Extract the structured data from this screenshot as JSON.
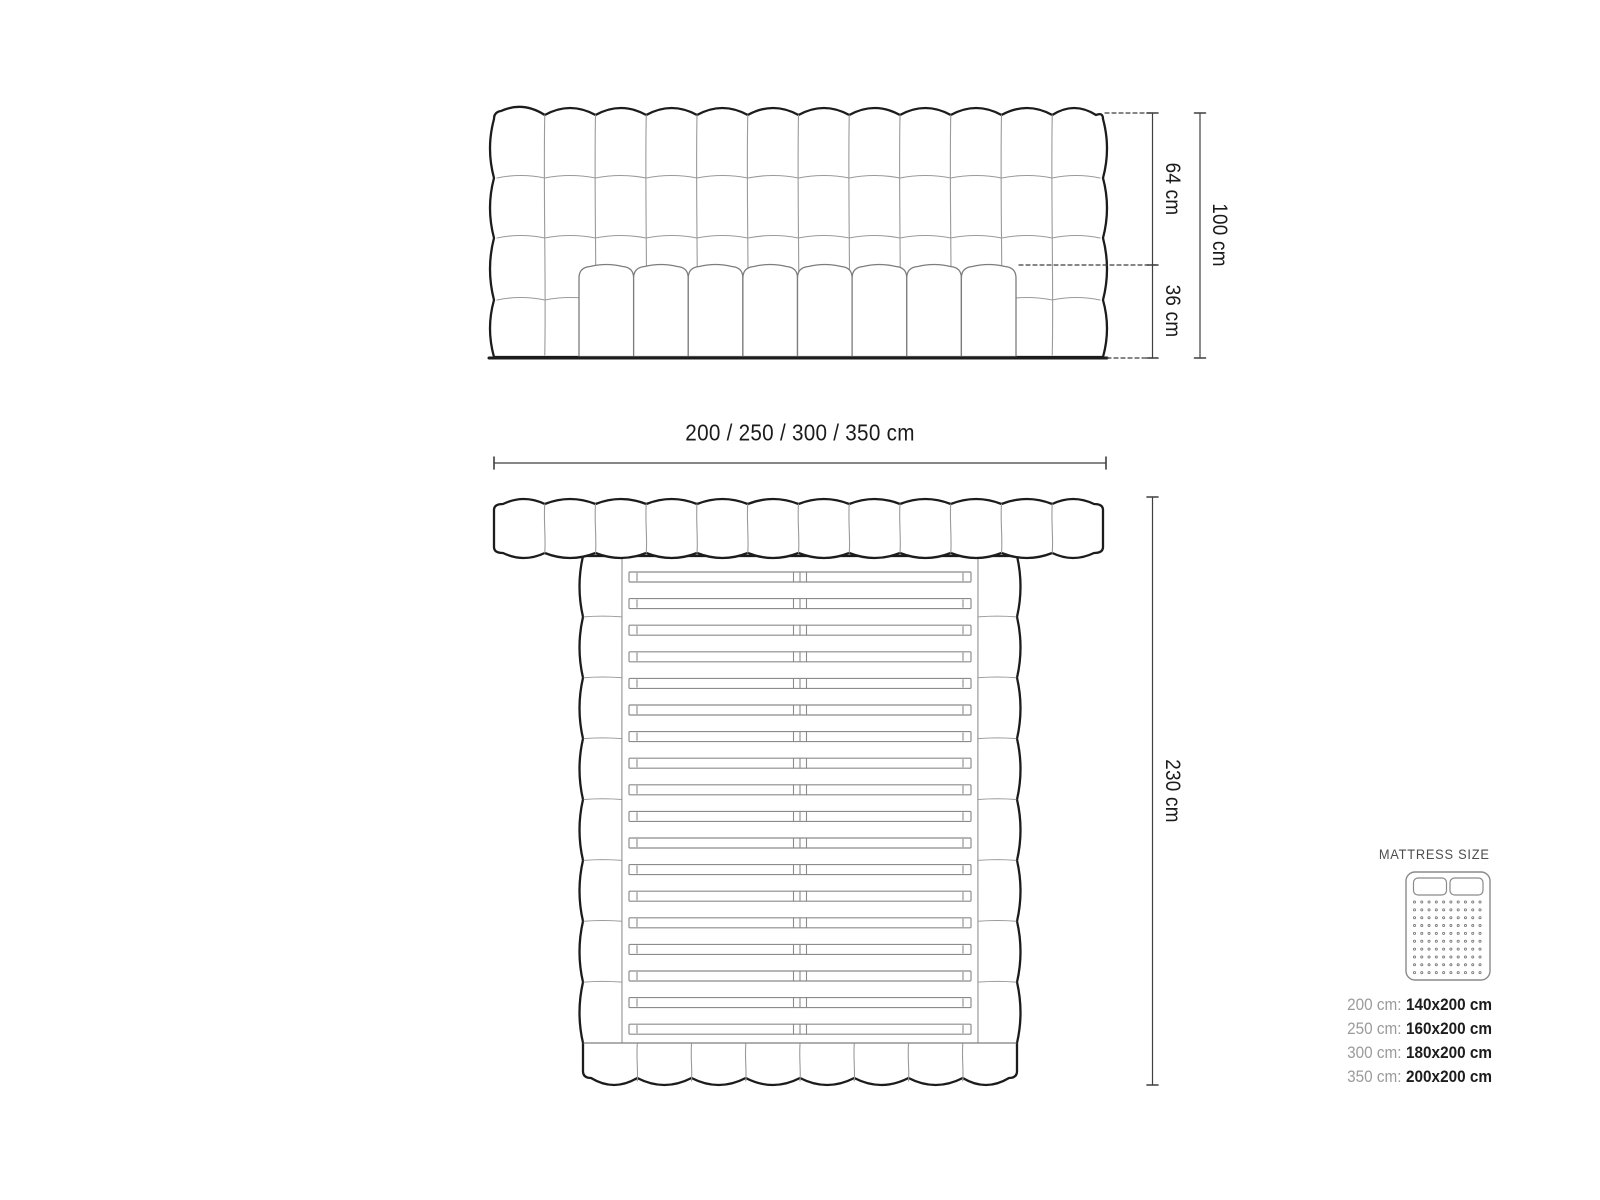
{
  "figure": {
    "front_view": {
      "dim_height_upper": "64 cm",
      "dim_height_lower": "36 cm",
      "dim_height_total": "100 cm",
      "dim_width": "200 / 250 / 300 / 350 cm",
      "headboard_columns": 12,
      "headboard_rows": 4,
      "mattress_panels": 8
    },
    "top_view": {
      "dim_length": "230 cm",
      "headboard_segments": 12,
      "footboard_segments": 8,
      "rail_blocks": 8,
      "slats": 18
    }
  },
  "legend": {
    "title": "MATTRESS SIZE",
    "rows": [
      {
        "frame": "200 cm:",
        "mattress": "140x200 cm"
      },
      {
        "frame": "250 cm:",
        "mattress": "160x200 cm"
      },
      {
        "frame": "300 cm:",
        "mattress": "180x200 cm"
      },
      {
        "frame": "350 cm:",
        "mattress": "200x200 cm"
      }
    ]
  },
  "colors": {
    "background": "#ffffff",
    "outline_dark": "#1c1c1c",
    "tuft_line": "#9a9a9a",
    "panel_line": "#7d7d7d",
    "slat_line": "#8b8b8b",
    "dimension_line": "#3f3f3f",
    "label_text": "#1b1b1b",
    "legend_muted": "#9b9b9b",
    "legend_value": "#1c1c1c",
    "legend_title": "#4d4d4d"
  }
}
